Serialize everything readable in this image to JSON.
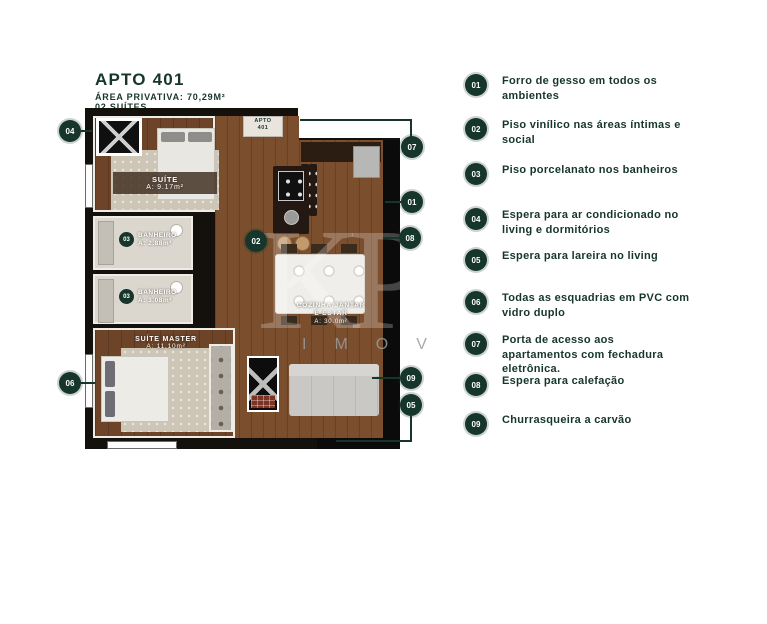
{
  "header": {
    "title": "APTO 401",
    "subtitle1": "ÁREA PRIVATIVA: 70,29M²",
    "subtitle2": "02 SUÍTES"
  },
  "colors": {
    "accent": "#16362c",
    "wood": "#7b4e2e",
    "bath": "#dbd7cf"
  },
  "plan": {
    "entry": {
      "line1": "APTO",
      "line2": "401"
    },
    "rooms": {
      "suite": {
        "name": "SUÍTE",
        "area": "A: 9.17m²"
      },
      "banheiro1": {
        "badge": "03",
        "name": "BANHEIRO",
        "area": "A: 2.88m²"
      },
      "banheiro2": {
        "badge": "03",
        "name": "BANHEIRO",
        "area": "A: 3.08m²"
      },
      "suite_master": {
        "name": "SUÍTE MASTER",
        "area": "A: 11.10m²"
      },
      "cozinha": {
        "badge": "02",
        "name_line1": "COZINHA/JANTAR",
        "name_line2": "E ESTAR",
        "area": "A: 30.0m²"
      }
    },
    "markers": {
      "m01": "01",
      "m02": "02",
      "m04": "04",
      "m05": "05",
      "m06": "06",
      "m07": "07",
      "m08": "08",
      "m09": "09"
    }
  },
  "legend": {
    "items": [
      {
        "num": "01",
        "text": "Forro de gesso em todos os ambientes"
      },
      {
        "num": "02",
        "text": "Piso vinílico nas áreas íntimas e social"
      },
      {
        "num": "03",
        "text": "Piso porcelanato nos banheiros"
      },
      {
        "num": "04",
        "text": "Espera para ar condicionado no living e dormitórios"
      },
      {
        "num": "05",
        "text": "Espera para lareira no living"
      },
      {
        "num": "06",
        "text": "Todas as esquadrias em PVC com vidro duplo"
      },
      {
        "num": "07",
        "text": "Porta de acesso aos apartamentos com fechadura eletrônica."
      },
      {
        "num": "08",
        "text": "Espera para calefação"
      },
      {
        "num": "09",
        "text": "Churrasqueira a carvão"
      }
    ]
  },
  "watermark": {
    "monogram": "KP",
    "letters": "IMOV"
  }
}
